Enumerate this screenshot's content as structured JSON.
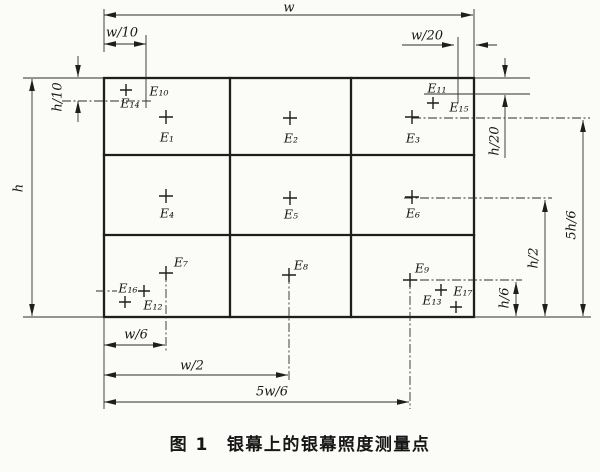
{
  "figure": {
    "label": "图 1",
    "title": "银幕上的银幕照度测量点"
  },
  "dimension_labels": {
    "width_full": "w",
    "width_tenth": "w/10",
    "width_twentieth": "w/20",
    "width_sixth": "w/6",
    "width_half": "w/2",
    "width_five_sixths": "5w/6",
    "height_full": "h",
    "height_tenth": "h/10",
    "height_twentieth": "h/20",
    "height_sixth": "h/6",
    "height_half": "h/2",
    "height_five_sixths": "5h/6"
  },
  "measurement_points": {
    "e1": "E₁",
    "e2": "E₂",
    "e3": "E₃",
    "e4": "E₄",
    "e5": "E₅",
    "e6": "E₆",
    "e7": "E₇",
    "e8": "E₈",
    "e9": "E₉",
    "e10": "E₁₀",
    "e11": "E₁₁",
    "e12": "E₁₂",
    "e13": "E₁₃",
    "e14": "E₁₄",
    "e15": "E₁₅",
    "e16": "E₁₆",
    "e17": "E₁₇"
  },
  "colors": {
    "ink": "#1e1e1e",
    "paper": "#fbfbf8"
  }
}
